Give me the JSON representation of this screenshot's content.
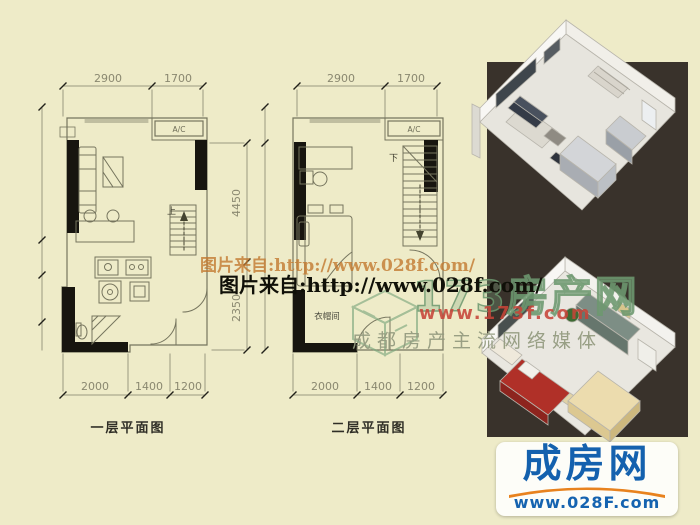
{
  "image": {
    "width": 700,
    "height": 525
  },
  "colors": {
    "background": "#eeebc8",
    "panel_dark": "#39322b",
    "wall_black": "#17150f",
    "plan_line": "#76755e",
    "dim_text": "#8a8870",
    "logo_blue": "#1461ae",
    "logo_orange": "#e8821e",
    "brand_green": "#6c986e",
    "brand_red": "#c64438",
    "slogan_gray": "#949b80",
    "watermark_orange": "#c1762b",
    "watermark_black": "#101008"
  },
  "plan1": {
    "title": "一层平面图",
    "dim_top": [
      "2900",
      "1700"
    ],
    "dim_right": [
      "4450",
      "2350"
    ],
    "dim_bottom": [
      "2000",
      "1400",
      "1200"
    ],
    "ac_label": "A/C",
    "stair_label": "上"
  },
  "plan2": {
    "title": "二层平面图",
    "dim_top": [
      "2900",
      "1700"
    ],
    "dim_bottom": [
      "2000",
      "1400",
      "1200"
    ],
    "ac_label": "A/C",
    "stair_label": "下",
    "room_label": "衣帽间"
  },
  "watermarks": {
    "url_line_top": "图片来自:http://www.028f.com/",
    "url_line_main": "图片来自:http://www.028f.com/",
    "brand_name": "173房产网",
    "brand_url": "www.173f.com",
    "brand_slogan": "成都房产主流网络媒体"
  },
  "logo": {
    "brand": "成房网",
    "url": "www.028F.com"
  }
}
